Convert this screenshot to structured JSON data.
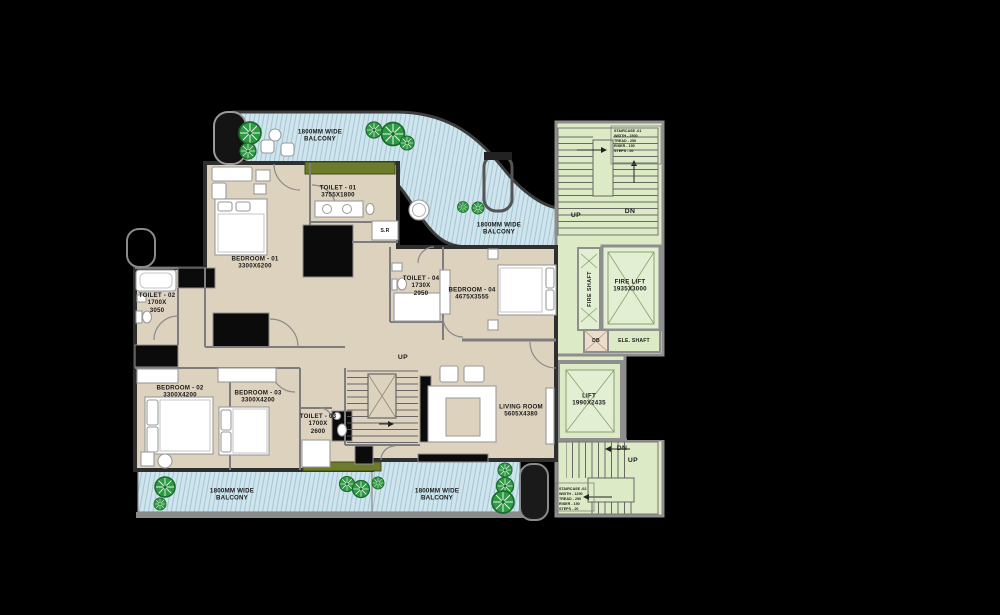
{
  "colors": {
    "beige": "#DDD2BE",
    "balcony": "#CFE4EC",
    "hatchLine": "#A3C6D4",
    "green": "#DCEAC6",
    "green2": "#E3EFD2",
    "olive": "#6E7B2A",
    "wallDark": "#2F2F2F",
    "wallGray": "#8E8E8E",
    "tree": "#2F9A44",
    "text": "#1C1C1C",
    "db": "#ECDCCB"
  },
  "labels": [
    {
      "name": "balcony-top-label",
      "cls": "room",
      "x": 320,
      "y": 136,
      "lines": [
        "1800MM WIDE",
        "BALCONY"
      ]
    },
    {
      "name": "balcony-right-label",
      "cls": "room",
      "x": 499,
      "y": 229,
      "lines": [
        "1800MM WIDE",
        "BALCONY"
      ]
    },
    {
      "name": "toilet-01-label",
      "cls": "room",
      "x": 338,
      "y": 192,
      "lines": [
        "TOILET - 01",
        "3755X1800"
      ]
    },
    {
      "name": "store-room-label",
      "cls": "small",
      "x": 385,
      "y": 231,
      "lines": [
        "S.R"
      ]
    },
    {
      "name": "bedroom-01-label",
      "cls": "room",
      "x": 255,
      "y": 263,
      "lines": [
        "BEDROOM - 01",
        "3300X6200"
      ]
    },
    {
      "name": "toilet-02-label",
      "cls": "room",
      "x": 157,
      "y": 303,
      "lines": [
        "TOILET - 02",
        "1700X",
        "3050"
      ]
    },
    {
      "name": "toilet-04-label",
      "cls": "room",
      "x": 421,
      "y": 286,
      "lines": [
        "TOILET - 04",
        "1730X",
        "2950"
      ]
    },
    {
      "name": "bedroom-04-label",
      "cls": "room",
      "x": 472,
      "y": 294,
      "lines": [
        "BEDROOM - 04",
        "4675X3555"
      ]
    },
    {
      "name": "stair-mid-up-label",
      "cls": "dir",
      "x": 403,
      "y": 358,
      "lines": [
        "UP"
      ]
    },
    {
      "name": "bedroom-02-label",
      "cls": "room",
      "x": 180,
      "y": 392,
      "lines": [
        "BEDROOM - 02",
        "3300X4200"
      ]
    },
    {
      "name": "bedroom-03-label",
      "cls": "room",
      "x": 258,
      "y": 397,
      "lines": [
        "BEDROOM - 03",
        "3300X4200"
      ]
    },
    {
      "name": "toilet-03-label",
      "cls": "room",
      "x": 318,
      "y": 424,
      "lines": [
        "TOILET - 03",
        "1700X",
        "2600"
      ]
    },
    {
      "name": "living-room-label",
      "cls": "room",
      "x": 521,
      "y": 411,
      "lines": [
        "LIVING ROOM",
        "5605X4380"
      ]
    },
    {
      "name": "balcony-bottom-left-label",
      "cls": "room",
      "x": 232,
      "y": 495,
      "lines": [
        "1800MM WIDE",
        "BALCONY"
      ]
    },
    {
      "name": "balcony-bottom-right-label",
      "cls": "room",
      "x": 437,
      "y": 495,
      "lines": [
        "1800MM WIDE",
        "BALCONY"
      ]
    },
    {
      "name": "stair1-up-label",
      "cls": "dir",
      "x": 576,
      "y": 216,
      "lines": [
        "UP"
      ]
    },
    {
      "name": "stair1-dn-label",
      "cls": "dir",
      "x": 630,
      "y": 212,
      "lines": [
        "DN"
      ]
    },
    {
      "name": "stair1-note",
      "cls": "note",
      "x": 614,
      "y": 129,
      "lines": [
        "STAIRCASE -01",
        "WIDTH - 1500",
        "TREAD - 250",
        "RISER - 150",
        "STEPS - 20"
      ]
    },
    {
      "name": "fire-shaft-label",
      "cls": "vert",
      "x": 590,
      "y": 289,
      "lines": [
        "FIRE SHAFT"
      ]
    },
    {
      "name": "fire-lift-label",
      "cls": "room",
      "x": 630,
      "y": 286,
      "lines": [
        "FIRE LIFT",
        "1935X3000"
      ]
    },
    {
      "name": "db-label",
      "cls": "small",
      "x": 596,
      "y": 341,
      "lines": [
        "DB"
      ]
    },
    {
      "name": "ele-shaft-label",
      "cls": "small",
      "x": 634,
      "y": 341,
      "lines": [
        "ELE. SHAFT"
      ]
    },
    {
      "name": "lift-label",
      "cls": "room",
      "x": 589,
      "y": 400,
      "lines": [
        "LIFT",
        "1990X2435"
      ]
    },
    {
      "name": "stair2-dn-label",
      "cls": "dir",
      "x": 622,
      "y": 449,
      "lines": [
        "DN"
      ]
    },
    {
      "name": "stair2-up-label",
      "cls": "dir",
      "x": 633,
      "y": 461,
      "lines": [
        "UP"
      ]
    },
    {
      "name": "stair2-note",
      "cls": "note",
      "x": 559,
      "y": 487,
      "lines": [
        "STAIRCASE -02",
        "WIDTH - 1250",
        "TREAD - 250",
        "RISER - 150",
        "STEPS - 20"
      ]
    }
  ]
}
